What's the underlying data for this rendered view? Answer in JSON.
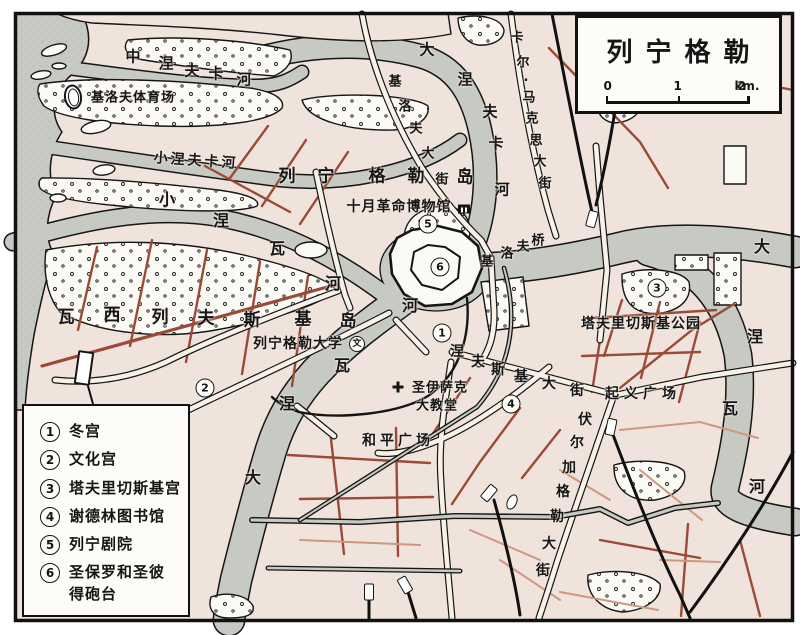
{
  "title_box": {
    "title": "列宁格勒",
    "scale_ticks": [
      "0",
      "1",
      "2"
    ],
    "scale_unit": "km."
  },
  "legend": {
    "items": [
      {
        "num": "1",
        "label": "冬宫"
      },
      {
        "num": "2",
        "label": "文化宫"
      },
      {
        "num": "3",
        "label": "塔夫里切斯基宫"
      },
      {
        "num": "4",
        "label": "谢德林图书馆"
      },
      {
        "num": "5",
        "label": "列宁剧院"
      },
      {
        "num": "6",
        "label": "圣保罗和圣彼\n得砲台"
      }
    ]
  },
  "map_markers": [
    {
      "num": "1",
      "x": 442,
      "y": 333
    },
    {
      "num": "2",
      "x": 205,
      "y": 388
    },
    {
      "num": "3",
      "x": 657,
      "y": 288
    },
    {
      "num": "4",
      "x": 511,
      "y": 404
    },
    {
      "num": "5",
      "x": 428,
      "y": 224
    },
    {
      "num": "6",
      "x": 440,
      "y": 267
    }
  ],
  "labels": [
    {
      "id": "kirov-stadium-label",
      "text": "基洛夫体育场",
      "x": 133,
      "y": 98,
      "size": 13,
      "ls": 1,
      "rot": 0
    },
    {
      "id": "malaya-nevka-river-label",
      "text": "小涅夫卡河",
      "x": 196,
      "y": 161,
      "size": 14,
      "ls": 3,
      "rot": 4
    },
    {
      "id": "october-museum-label",
      "text": "十月革命博物馆",
      "x": 399,
      "y": 207,
      "size": 14,
      "ls": 1,
      "rot": 0
    },
    {
      "id": "tavrichesky-park-label",
      "text": "塔夫里切斯基公园",
      "x": 641,
      "y": 324,
      "size": 14,
      "ls": 1,
      "rot": 0
    },
    {
      "id": "leningrad-university-label",
      "text": "列宁格勒大学",
      "x": 298,
      "y": 344,
      "size": 14,
      "ls": 1,
      "rot": 0
    },
    {
      "id": "isaac-cathedral-label-line1",
      "text": "圣伊萨克",
      "x": 440,
      "y": 388,
      "size": 13,
      "ls": 1,
      "rot": 0
    },
    {
      "id": "isaac-cathedral-label-line2",
      "text": "大教堂",
      "x": 437,
      "y": 406,
      "size": 13,
      "ls": 1,
      "rot": 0
    },
    {
      "id": "uprising-square-label",
      "text": "起义广场",
      "x": 643,
      "y": 394,
      "size": 14,
      "ls": 5,
      "rot": 0
    },
    {
      "id": "peace-square-label",
      "text": "和平广场",
      "x": 398,
      "y": 441,
      "size": 14,
      "ls": 4,
      "rot": 0
    },
    {
      "id": "university-symbol",
      "text": "文",
      "x": 357,
      "y": 344,
      "size": 9,
      "ls": 0,
      "rot": 0,
      "circled": true
    }
  ],
  "char_labels": [
    {
      "id": "srednyaya-nevka-river-label",
      "text": "中涅夫卡河",
      "size": 15,
      "chars": [
        [
          133,
          57
        ],
        [
          166,
          64
        ],
        [
          192,
          71
        ],
        [
          216,
          74
        ],
        [
          244,
          80
        ]
      ]
    },
    {
      "id": "bolshaya-nevka-river-label",
      "text": "大涅夫卡河",
      "size": 15,
      "chars": [
        [
          427,
          50
        ],
        [
          465,
          80
        ],
        [
          490,
          112
        ],
        [
          496,
          144
        ],
        [
          502,
          190
        ]
      ]
    },
    {
      "id": "malaya-neva-river-label",
      "text": "小涅瓦河",
      "size": 16,
      "chars": [
        [
          167,
          200
        ],
        [
          221,
          221
        ],
        [
          277,
          249
        ],
        [
          333,
          284
        ]
      ]
    },
    {
      "id": "kirov-street-label",
      "text": "基洛夫大街",
      "size": 13,
      "chars": [
        [
          395,
          82
        ],
        [
          405,
          107
        ],
        [
          416,
          129
        ],
        [
          428,
          154
        ],
        [
          442,
          180
        ]
      ]
    },
    {
      "id": "karl-marx-street-label",
      "text": "卡尔·马克思大街",
      "size": 13,
      "chars": [
        [
          517,
          38
        ],
        [
          523,
          63
        ],
        [
          526,
          81
        ],
        [
          529,
          98
        ],
        [
          532,
          119
        ],
        [
          536,
          141
        ],
        [
          540,
          162
        ],
        [
          545,
          184
        ]
      ]
    },
    {
      "id": "kirov-bridge-label",
      "text": "基洛夫桥",
      "size": 13,
      "chars": [
        [
          487,
          262
        ],
        [
          507,
          254
        ],
        [
          523,
          247
        ],
        [
          538,
          241
        ]
      ]
    },
    {
      "id": "bolshaya-neva-river-label",
      "text": "大涅瓦河",
      "size": 16,
      "chars": [
        [
          253,
          478
        ],
        [
          287,
          404
        ],
        [
          342,
          366
        ],
        [
          410,
          306
        ]
      ]
    },
    {
      "id": "nevsky-prospekt-label",
      "text": "涅夫斯基大街",
      "size": 14,
      "chars": [
        [
          457,
          352
        ],
        [
          478,
          362
        ],
        [
          498,
          370
        ],
        [
          521,
          377
        ],
        [
          549,
          384
        ],
        [
          577,
          391
        ]
      ]
    },
    {
      "id": "volgograd-street-label",
      "text": "伏尔加格勒大街",
      "size": 14,
      "chars": [
        [
          585,
          420
        ],
        [
          577,
          443
        ],
        [
          569,
          468
        ],
        [
          563,
          492
        ],
        [
          557,
          517
        ],
        [
          549,
          544
        ],
        [
          543,
          571
        ]
      ]
    },
    {
      "id": "neva-river-east-label",
      "text": "大涅瓦河",
      "size": 16,
      "chars": [
        [
          762,
          247
        ],
        [
          755,
          337
        ],
        [
          730,
          409
        ],
        [
          757,
          487
        ]
      ]
    },
    {
      "id": "vasilyevsky-island-label",
      "text": "瓦西列夫斯基岛",
      "size": 17,
      "chars": [
        [
          66,
          318
        ],
        [
          112,
          316
        ],
        [
          160,
          318
        ],
        [
          206,
          319
        ],
        [
          252,
          321
        ],
        [
          303,
          320
        ],
        [
          348,
          322
        ]
      ]
    },
    {
      "id": "leningrad-island-label",
      "text": "列宁格勒岛",
      "size": 17,
      "chars": [
        [
          287,
          177
        ],
        [
          326,
          177
        ],
        [
          377,
          177
        ],
        [
          416,
          177
        ],
        [
          465,
          178
        ]
      ]
    }
  ],
  "icons": [
    {
      "name": "stadium-icon",
      "x": 73,
      "y": 97,
      "rot": -8
    },
    {
      "name": "stadium-icon-small",
      "x": 512,
      "y": 502,
      "rot": 25
    },
    {
      "name": "museum-building-icon",
      "x": 464,
      "y": 209,
      "rot": 0
    },
    {
      "name": "cathedral-cross-icon",
      "x": 398,
      "y": 387,
      "rot": 0
    },
    {
      "name": "harbor-dock-icon",
      "x": 84,
      "y": 368,
      "rot": 8
    },
    {
      "name": "station-icon",
      "x": 592,
      "y": 219,
      "rot": 15
    },
    {
      "name": "station-icon",
      "x": 611,
      "y": 427,
      "rot": 12
    },
    {
      "name": "station-icon",
      "x": 489,
      "y": 493,
      "rot": 40
    },
    {
      "name": "station-icon",
      "x": 369,
      "y": 592,
      "rot": 0
    },
    {
      "name": "station-icon",
      "x": 405,
      "y": 585,
      "rot": -30
    }
  ],
  "colors": {
    "land": "#f0e3dc",
    "water": "#c7cac3",
    "road_major_fill": "#f7f1e8",
    "road_secondary": "#9a4a37",
    "road_minor": "#cd9780",
    "ink": "#151515"
  }
}
